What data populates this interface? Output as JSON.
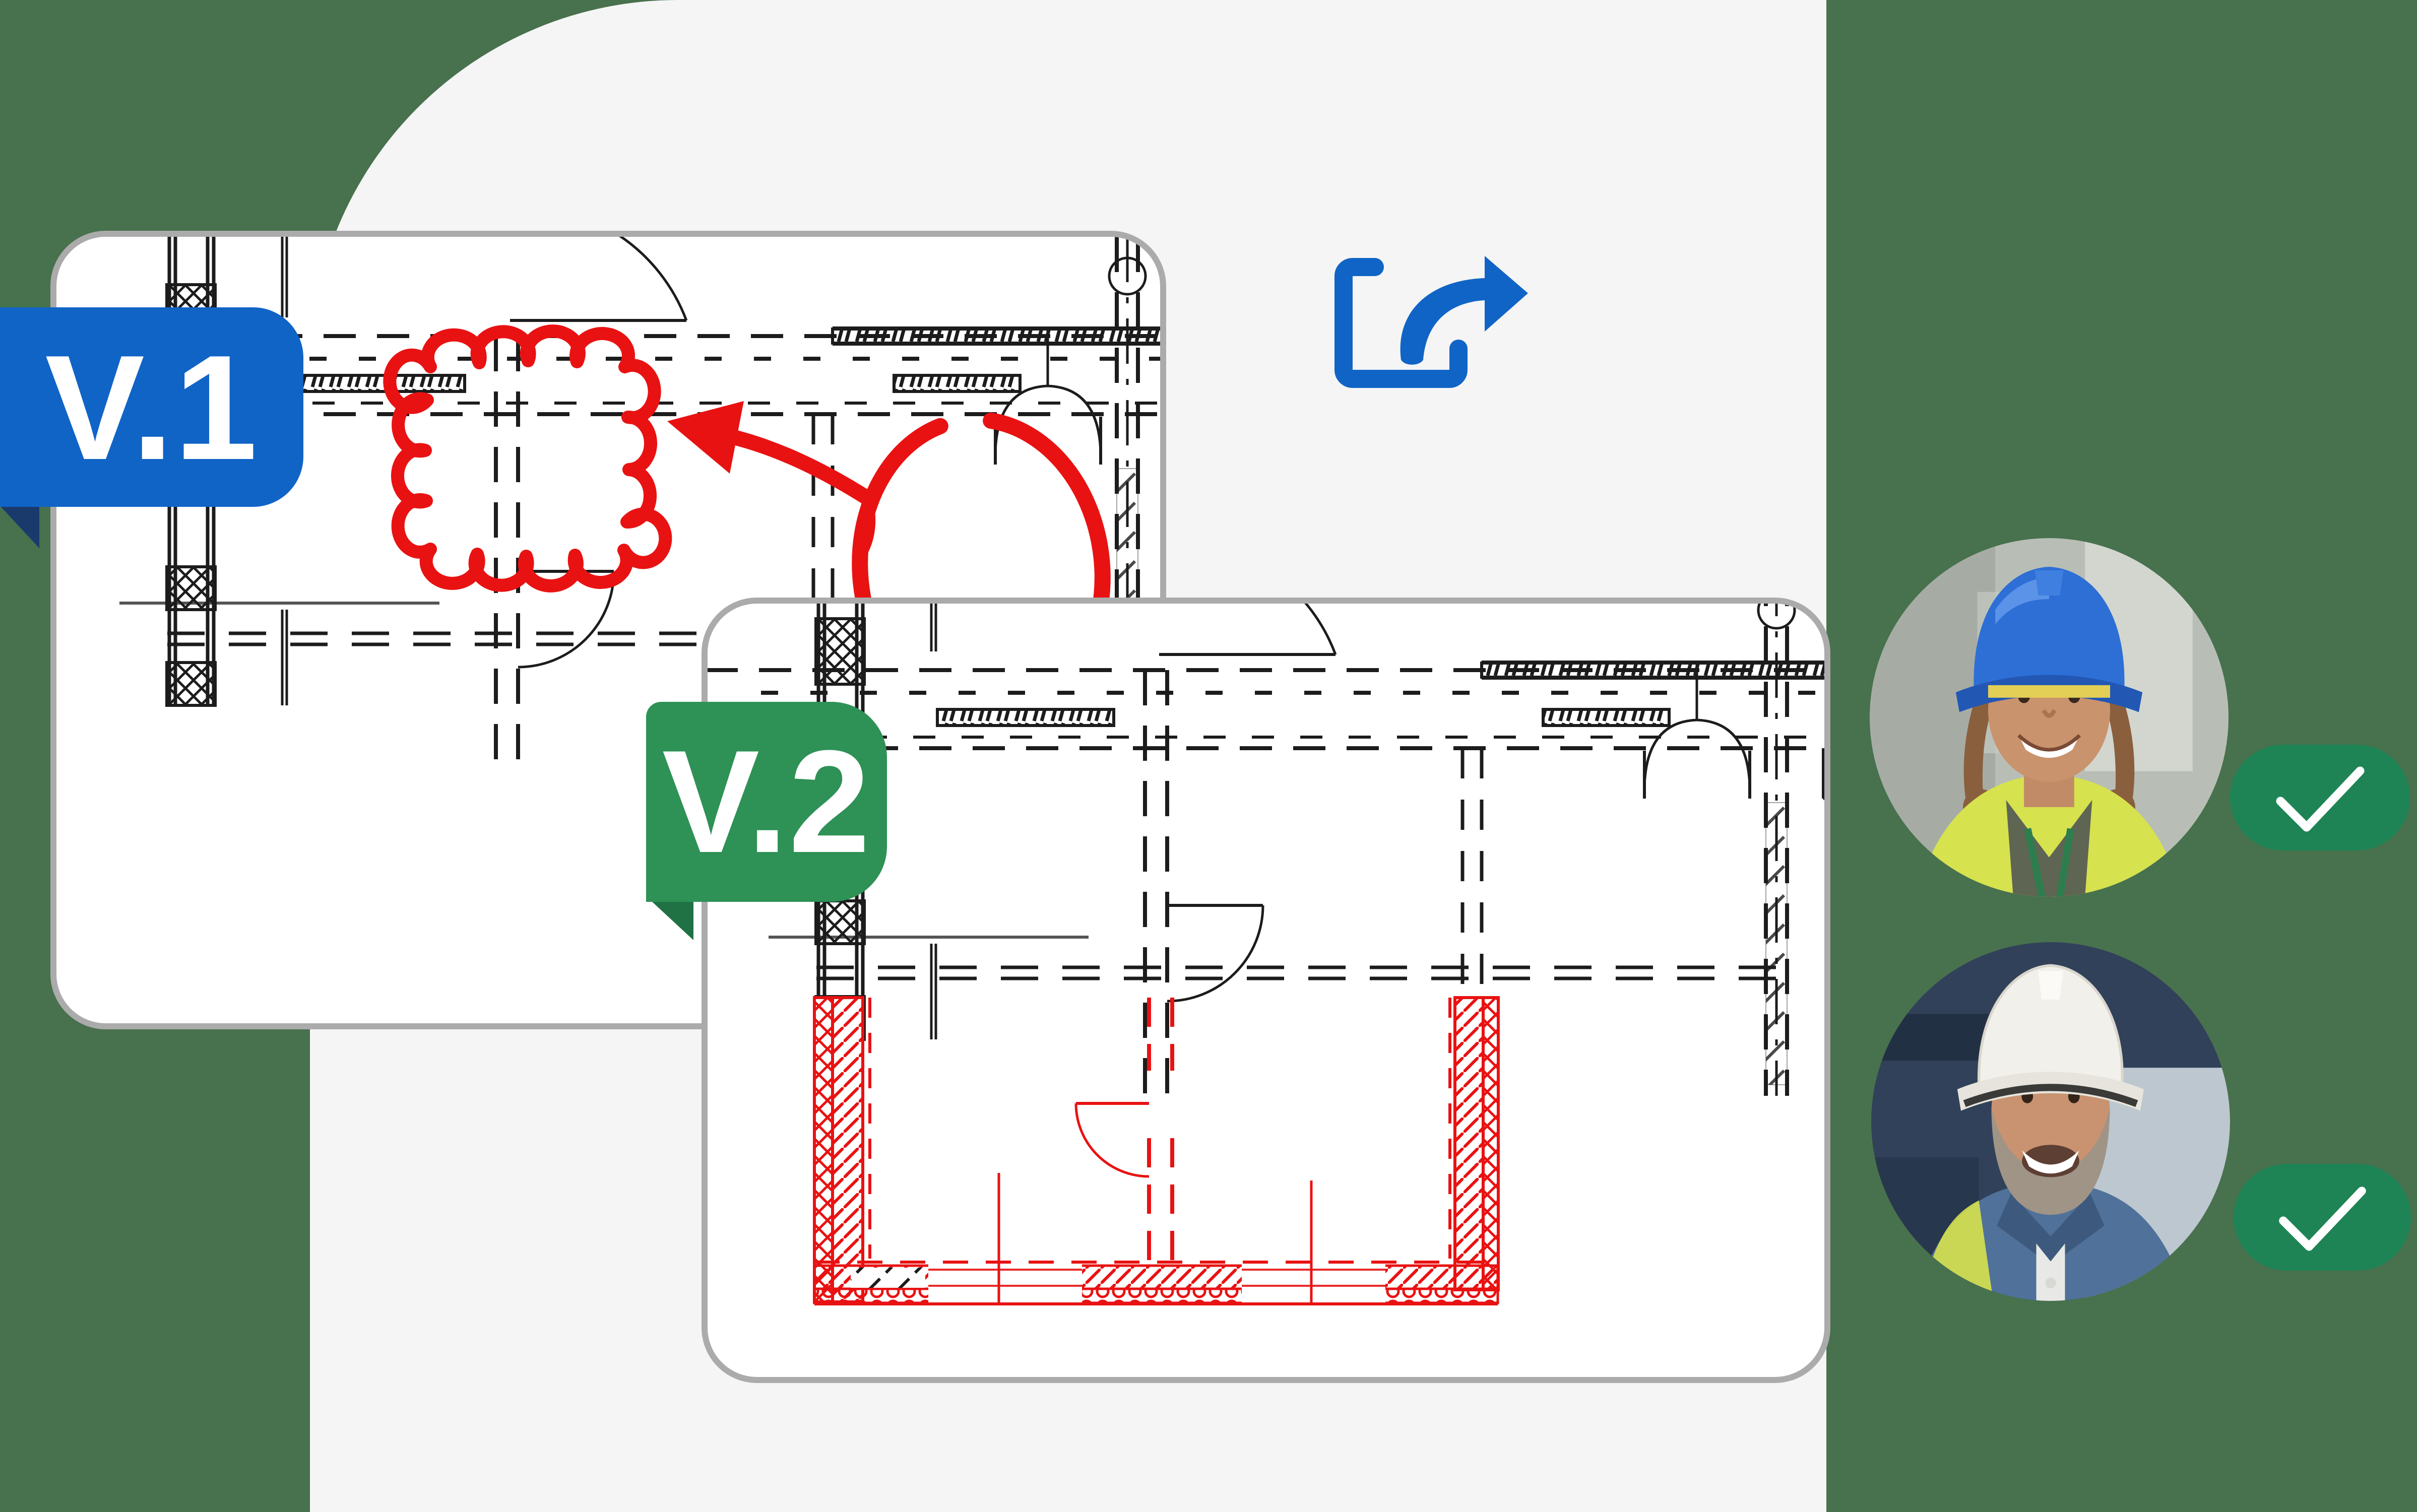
{
  "badges": {
    "v1": {
      "label": "V.1",
      "color": "#1064C6"
    },
    "v2": {
      "label": "V.2",
      "color": "#2E9156"
    }
  },
  "cards": {
    "v1": {
      "content": "floor-plan-drawing",
      "annotations": [
        "revision-cloud",
        "hand-drawn-arrow",
        "circle-highlight"
      ]
    },
    "v2": {
      "content": "floor-plan-drawing",
      "annotations": [
        "new-walls-highlighted-red"
      ]
    }
  },
  "share": {
    "icon": "share-export-arrow-icon",
    "color": "#1064C6"
  },
  "avatars": [
    {
      "name": "construction-worker-woman-blue-helmet",
      "status": "approved"
    },
    {
      "name": "construction-worker-man-white-helmet",
      "status": "approved"
    }
  ],
  "approval": {
    "check_icon": "checkmark-icon",
    "pill_color": "#1E8455"
  },
  "colors": {
    "bgGreen": "#48714D",
    "panelGray": "#F5F5F5",
    "cardBorder": "#ABABAB",
    "blue": "#1064C6",
    "blueDark": "#1A3A6C",
    "green": "#2E9156",
    "greenDark": "#207144",
    "pillGreen": "#1E8455",
    "red": "#E91212",
    "ink": "#1C1C1C"
  }
}
